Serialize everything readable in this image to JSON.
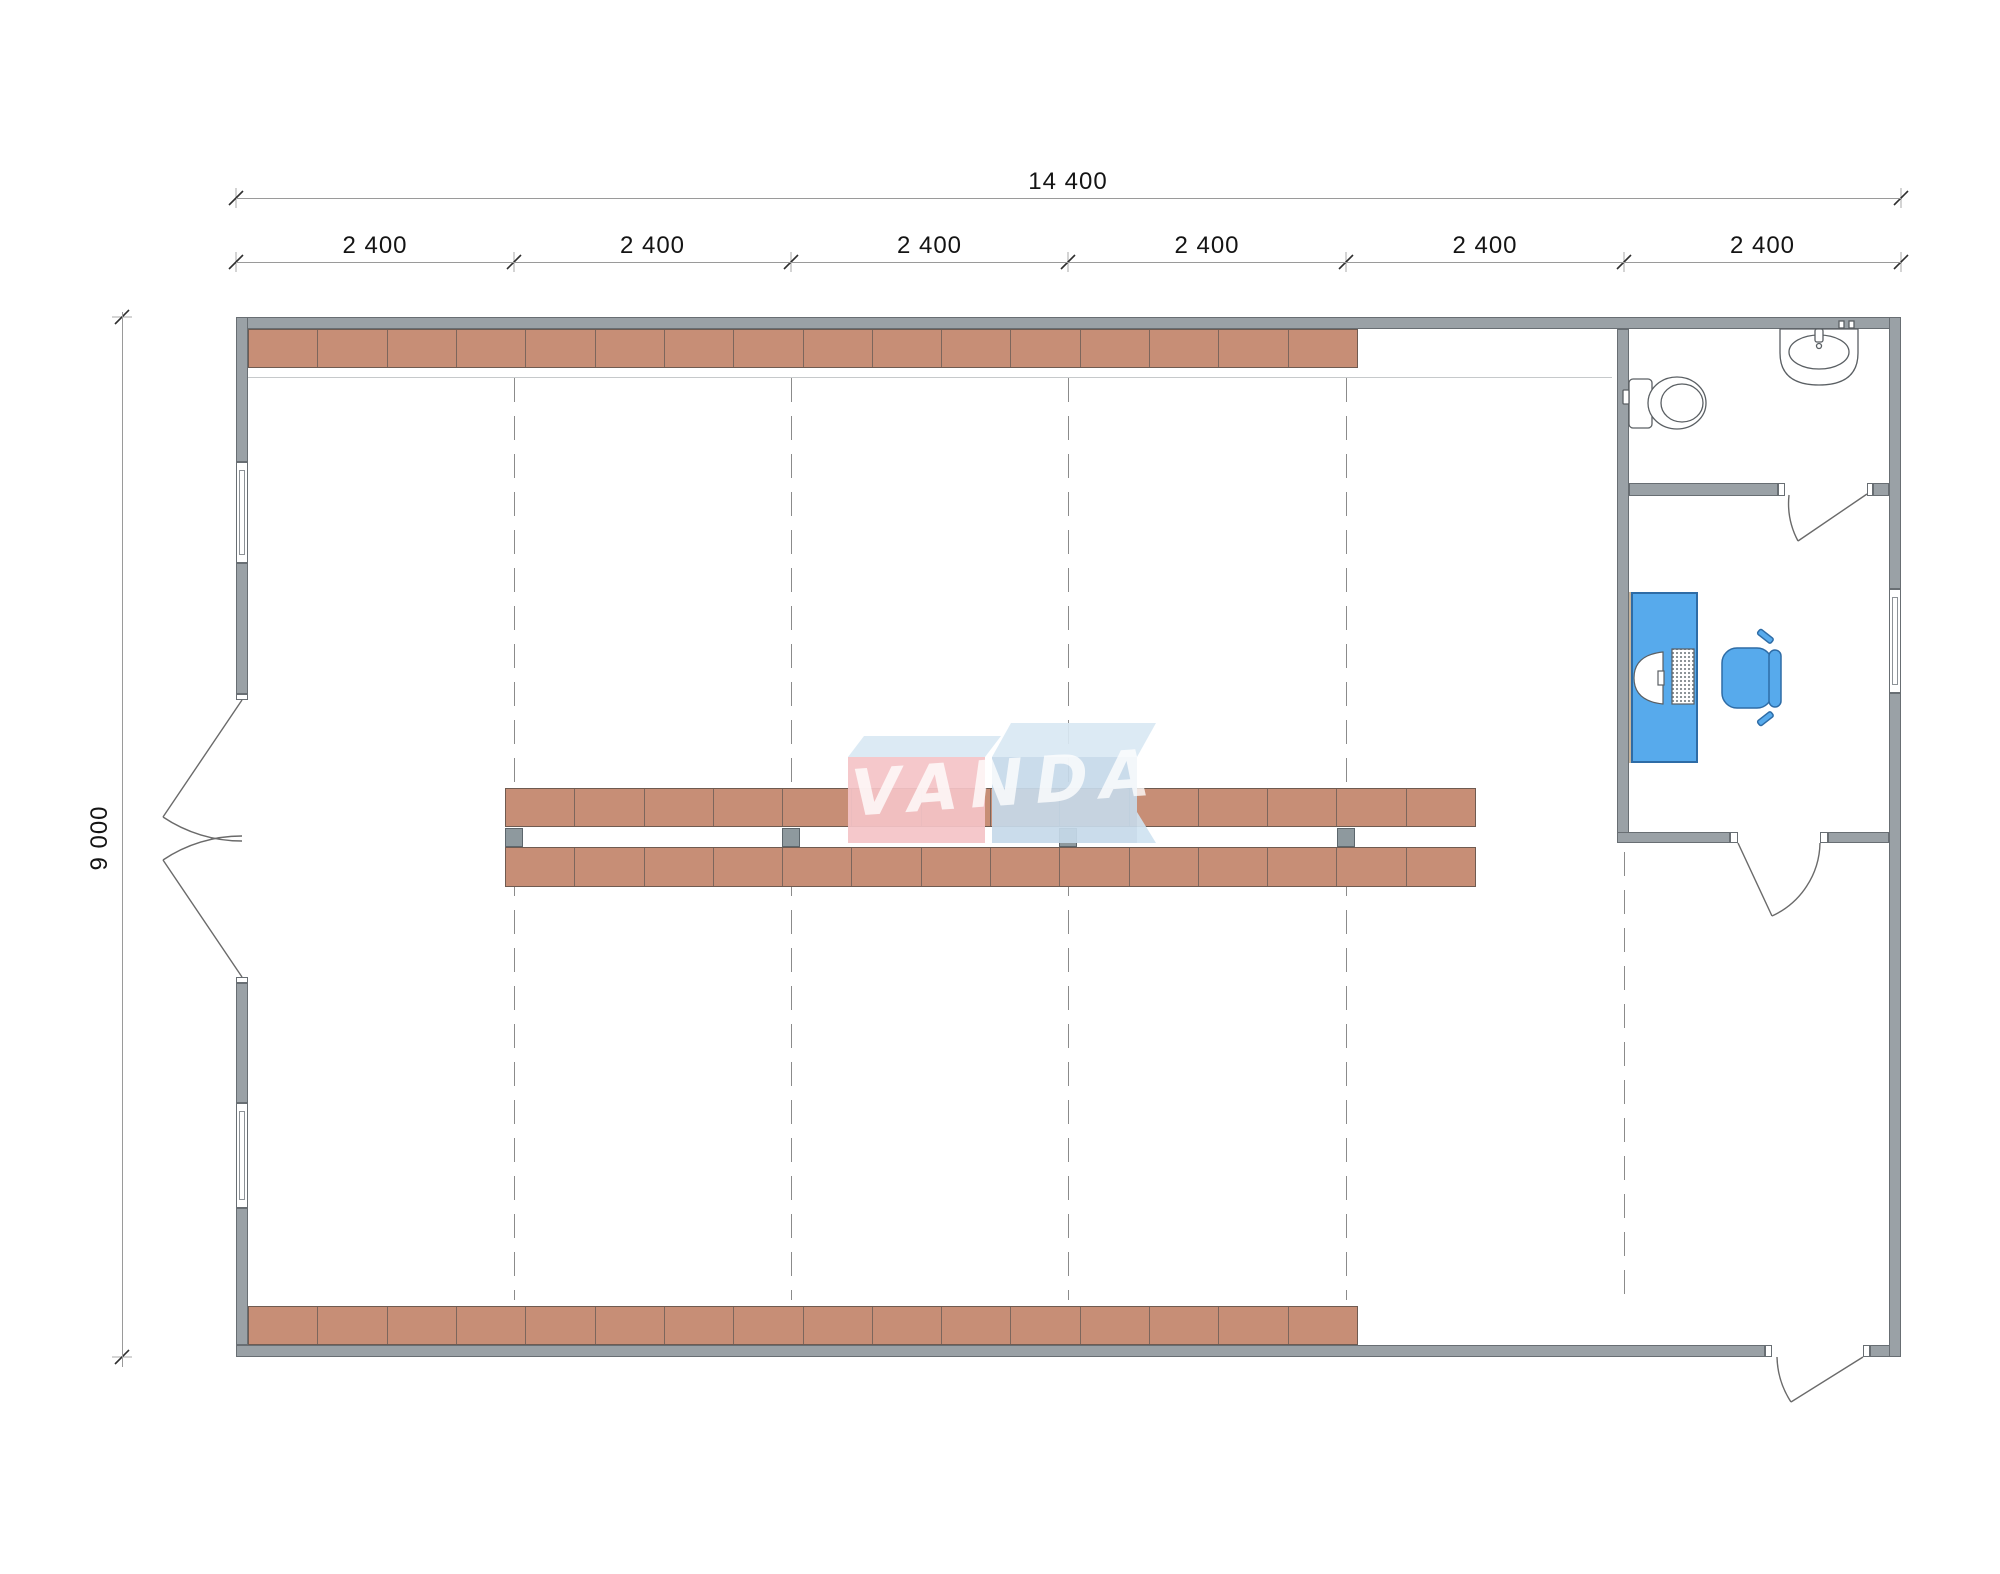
{
  "plan": {
    "type": "warehouse-floor-plan",
    "dimensions": {
      "total_width_label": "14 400",
      "bay_labels": [
        "2 400",
        "2 400",
        "2 400",
        "2 400",
        "2 400",
        "2 400"
      ],
      "total_height_label": "9 000"
    },
    "watermark": {
      "text": "VANDA"
    },
    "shelving": {
      "top_wall_units": 16,
      "bottom_wall_units": 16,
      "center_row_units": 14,
      "center_rows": 2,
      "aisle_posts": 4
    },
    "fixtures": [
      "toilet",
      "sink",
      "desk",
      "office-chair",
      "monitor",
      "keyboard",
      "double-entry-door",
      "bathroom-door",
      "office-door",
      "exterior-door"
    ],
    "colors": {
      "wall": "#9aa1a6",
      "wall_border": "#686e73",
      "shelf": "#c78e76",
      "shelf_border": "#6f5b51",
      "shelf_divider": "#7d665c",
      "post": "#8e999e",
      "post_border": "#5c666c",
      "furniture": "#57aaec",
      "furniture_border": "#2e6ca6",
      "dash": "#8b8b8b",
      "dim_line": "#9a9a9a",
      "dim_text": "#141414",
      "fixture_stroke": "#5a5f63",
      "watermark_pink": "#f5c3c7",
      "watermark_blue": "#c6d9ea",
      "watermark_top": "#d9e9f4",
      "watermark_text": "rgba(255,255,255,0.78)"
    }
  }
}
